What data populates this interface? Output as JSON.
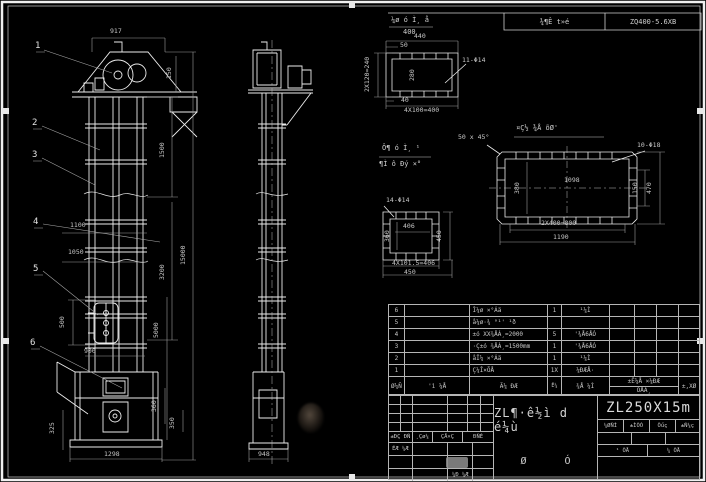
{
  "header": {
    "note_top": "¼ø ó Ì¸ å",
    "note_bottom": "400",
    "cell_project": "¾¶Ê t»é",
    "cell_model": "ZQ400-5.6XB"
  },
  "balloons": {
    "b1": "1",
    "b2": "2",
    "b3": "3",
    "b4": "4",
    "b5": "5",
    "b6": "6"
  },
  "dims": {
    "front": {
      "w917": "917",
      "h150": "150",
      "h1500": "1500",
      "h3200": "3200",
      "h15000": "15000",
      "h5000": "5000",
      "w1100": "1100",
      "w1050": "1050",
      "h500": "500",
      "w900": "900",
      "h325": "325",
      "h360": "360",
      "h350": "350",
      "w1298": "1298"
    },
    "side": {
      "w948": "948"
    },
    "d1": {
      "holes": "11-Φ14",
      "top": "440",
      "small": "50",
      "left": "2X120=240",
      "inner": "280",
      "s40": "40",
      "bottom": "4X100=400"
    },
    "d2": {
      "title": "¤Ç½ ¾Å õØ'",
      "chamfer": "50 x 45°",
      "holes": "10-Φ18",
      "w1098": "1098",
      "h380": "380",
      "h150": "150",
      "h470": "470",
      "b800": "2X400=800",
      "b1190": "1190"
    },
    "d3": {
      "holes": "14-Φ14",
      "w406": "406",
      "h360": "360",
      "h450": "450",
      "b406": "4X101.5=406",
      "b450": "450"
    }
  },
  "note_block": {
    "line1": "Ô¶ ó Ì¸ ¹",
    "line2": "¶Ì ô Ðý ×°"
  },
  "bom": {
    "rows": [
      {
        "no": "6",
        "code": "",
        "name": "Î¼ø ×°Áä",
        "qty": "1",
        "mat": "¹¼Ì"
      },
      {
        "no": "5",
        "code": "",
        "name": "å¼ø·¾ °¹' ¹ð",
        "qty": "",
        "mat": ""
      },
      {
        "no": "4",
        "code": "",
        "name": "±ó XX¾ÅÁ¸=2000",
        "qty": "5",
        "mat": "'¾Å6ÅÓ"
      },
      {
        "no": "3",
        "code": "",
        "name": "·Ç±ó ¾ÅÁ¸=1500mm",
        "qty": "1",
        "mat": "'¾Å6ÅÓ"
      },
      {
        "no": "2",
        "code": "",
        "name": "åÎ¼ ×°Áä",
        "qty": "1",
        "mat": "¹¼Ì"
      },
      {
        "no": "1",
        "code": "",
        "name": "Ç¼Î×ÕÅ",
        "qty": "1X",
        "mat": "¼ÐÆÅ·"
      }
    ],
    "header": {
      "no": "Ø¼Ñ",
      "code": "'ì ¼Å",
      "name": "Ã¼ ÐÆ",
      "qty": "Ê¼",
      "mat": "¾Å ¼Ì",
      "tot_top": "±Ê¼Å ×¼ÐÆ",
      "tot_bottom": "ÕÅÁ¸",
      "rem": "±,XØ"
    }
  },
  "title_block": {
    "left_headers": {
      "h1": "±ÐÇ ÐÑ",
      "h2": "¸Çø¼",
      "h3": "ÇÅ×Ç",
      "h4": "ÐÑÈ"
    },
    "sig1": "ÉÆ ¼Æ",
    "sig2": "¼Ð ¼Æ",
    "title": "ZL¶·ê½ì d é¼ù",
    "subtitle": "Ø Ó",
    "model": "ZL250X15m",
    "right_headers": {
      "h1": "¼ØÑÌ",
      "h2": "±ÌÒÓ",
      "h3": "Õűç",
      "h4": "±Ñ¼ç"
    },
    "sheet_left": "¹ ÕÅ",
    "sheet_right": "¼ ÕÅ"
  }
}
